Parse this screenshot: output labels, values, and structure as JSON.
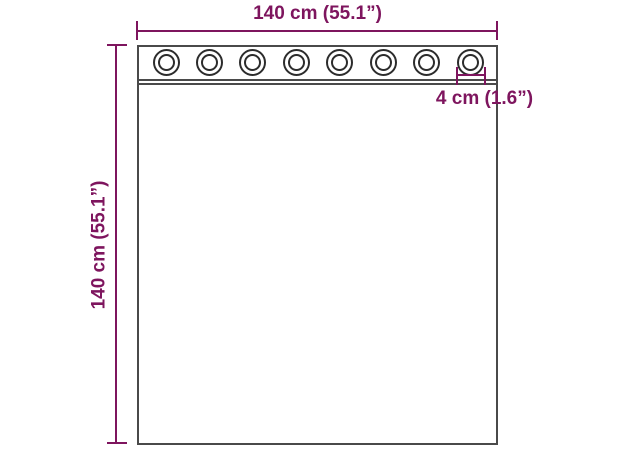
{
  "figure": {
    "description": "Dimension diagram of a curtain panel with grommets",
    "labels": {
      "width": "140 cm (55.1”)",
      "height": "140 cm (55.1”)",
      "grommet": "4 cm (1.6”)"
    },
    "grommets": {
      "count": 8
    },
    "colors": {
      "dimension_accent": "#7e155e",
      "outline": "#4a4a4a",
      "grommet_ring": "#2c2c2c",
      "background": "#ffffff"
    }
  }
}
